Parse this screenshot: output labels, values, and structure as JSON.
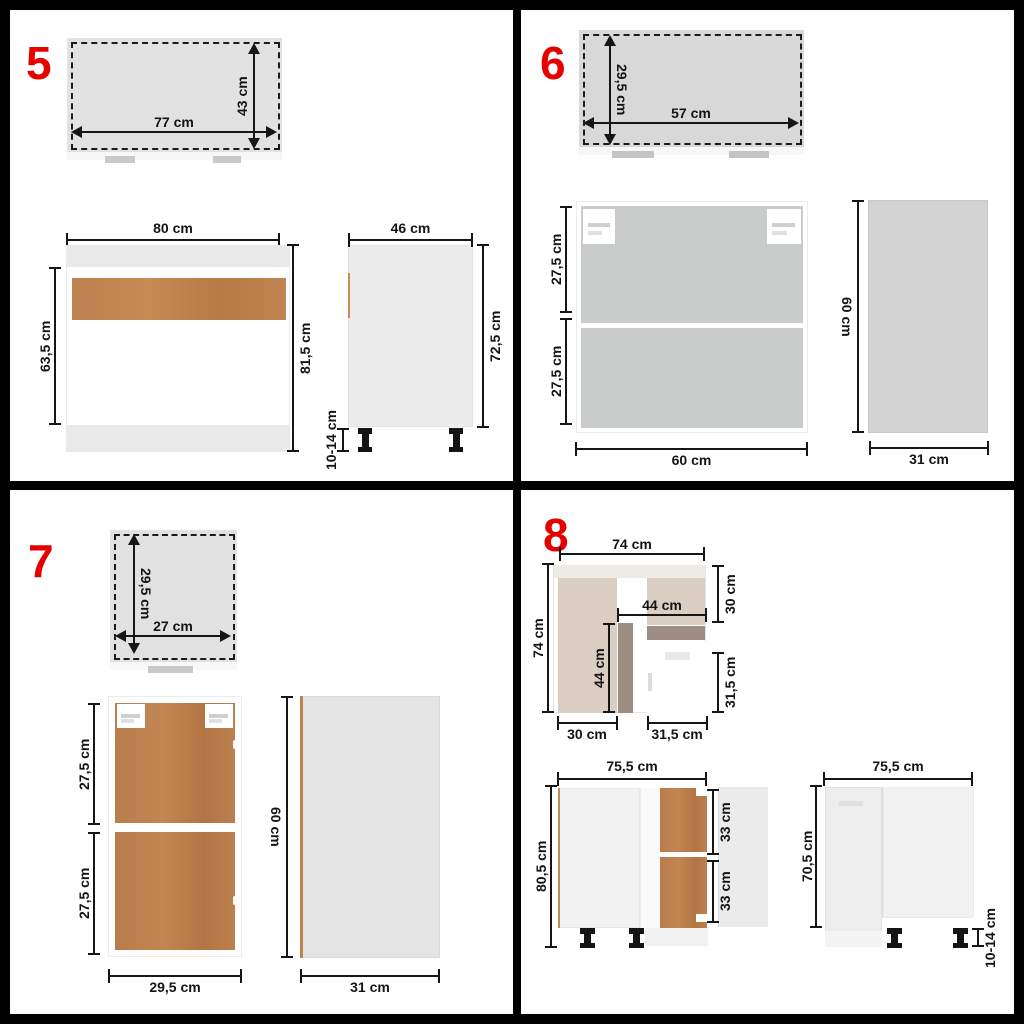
{
  "colors": {
    "accent_red": "#e60000",
    "wood_light": "#c18a58",
    "wood_dark": "#b97c4b",
    "beige": "#dacdc1",
    "taupe": "#9d8d83",
    "panel_gray": "#d2d2d2"
  },
  "panels": {
    "p5": {
      "number": "5",
      "top_view": {
        "width": "77 cm",
        "height": "43 cm"
      },
      "front_view": {
        "width": "80 cm",
        "inner_height": "63,5 cm",
        "height": "81,5 cm"
      },
      "side_view": {
        "width": "46 cm",
        "height": "72,5 cm",
        "legs": "10-14 cm"
      }
    },
    "p6": {
      "number": "6",
      "top_view": {
        "height": "29,5 cm",
        "width": "57 cm"
      },
      "front_view": {
        "upper": "27,5 cm",
        "lower": "27,5 cm",
        "width": "60 cm"
      },
      "side_view": {
        "height": "60 cm",
        "width": "31 cm"
      }
    },
    "p7": {
      "number": "7",
      "top_view": {
        "height": "29,5 cm",
        "width": "27 cm"
      },
      "front_view": {
        "upper": "27,5 cm",
        "lower": "27,5 cm",
        "width": "29,5 cm"
      },
      "side_view": {
        "height": "60 cm",
        "width": "31 cm"
      }
    },
    "p8": {
      "number": "8",
      "top_view": {
        "width": "74 cm",
        "depth": "74 cm",
        "inner_width": "44 cm",
        "inner_depth": "44 cm",
        "right_top": "30 cm",
        "right_bottom": "31,5 cm",
        "bottom_left": "30 cm",
        "bottom_middle": "31,5 cm"
      },
      "front_view": {
        "width": "75,5 cm",
        "height": "80,5 cm",
        "door_upper": "33 cm",
        "door_lower": "33 cm"
      },
      "side_view": {
        "width": "75,5 cm",
        "height": "70,5 cm",
        "legs": "10-14 cm"
      }
    }
  }
}
